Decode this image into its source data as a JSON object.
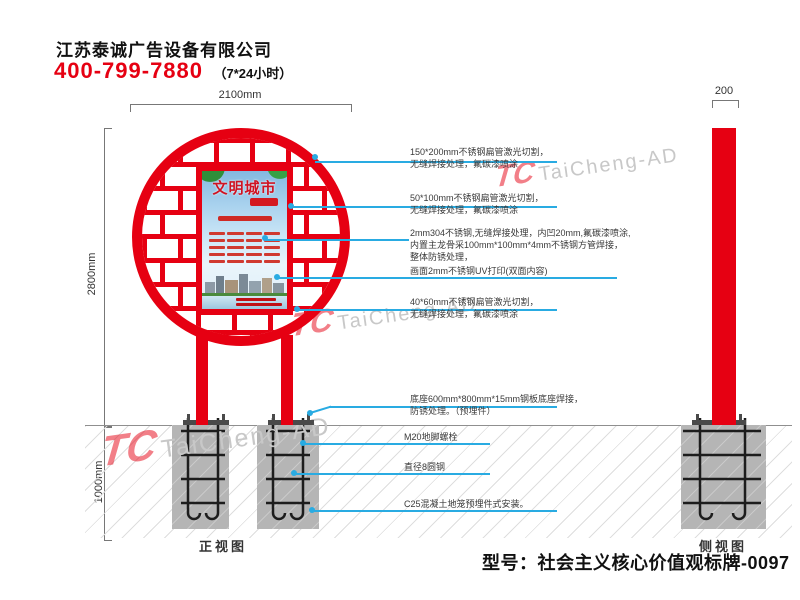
{
  "header": {
    "company": "江苏泰诚广告设备有限公司",
    "phone": "400-799-7880",
    "hours": "（7*24小时）"
  },
  "dimensions": {
    "top_width": "2100mm",
    "main_height": "2800mm",
    "underground_height": "1000mm",
    "side_width": "200"
  },
  "views": {
    "front": "正视图",
    "side": "侧视图"
  },
  "poster": {
    "title": "文明城市"
  },
  "watermark": {
    "logo": "TC",
    "text": "TaiCheng-AD"
  },
  "annotations": [
    {
      "l1": "150*200mm不锈钢扁管激光切割，",
      "l2": "无缝焊接处理，氟碳漆喷涂"
    },
    {
      "l1": "50*100mm不锈钢扁管激光切割，",
      "l2": "无缝焊接处理，氟碳漆喷涂"
    },
    {
      "l1": "2mm304不锈钢,无缝焊接处理，内凹20mm,氟碳漆喷涂,",
      "l2": "内置主龙骨采100mm*100mm*4mm不锈钢方管焊接，",
      "l3": "整体防锈处理，"
    },
    {
      "l1": "画面2mm不锈钢UV打印(双面内容)"
    },
    {
      "l1": "40*60mm不锈钢扁管激光切割，",
      "l2": "无缝焊接处理，氟碳漆喷涂"
    },
    {
      "l1": "底座600mm*800mm*15mm钢板底座焊接，",
      "l2": "防锈处理。（预埋件）"
    },
    {
      "l1": "M20地脚螺栓"
    },
    {
      "l1": "直径8圆钢"
    },
    {
      "l1": "C25混凝土地笼预埋件式安装。"
    }
  ],
  "model_label": "型号：社会主义核心价值观标牌-0097",
  "colors": {
    "red": "#e60012",
    "blue": "#29abe2",
    "foundation_gray": "#b5b5b5"
  }
}
